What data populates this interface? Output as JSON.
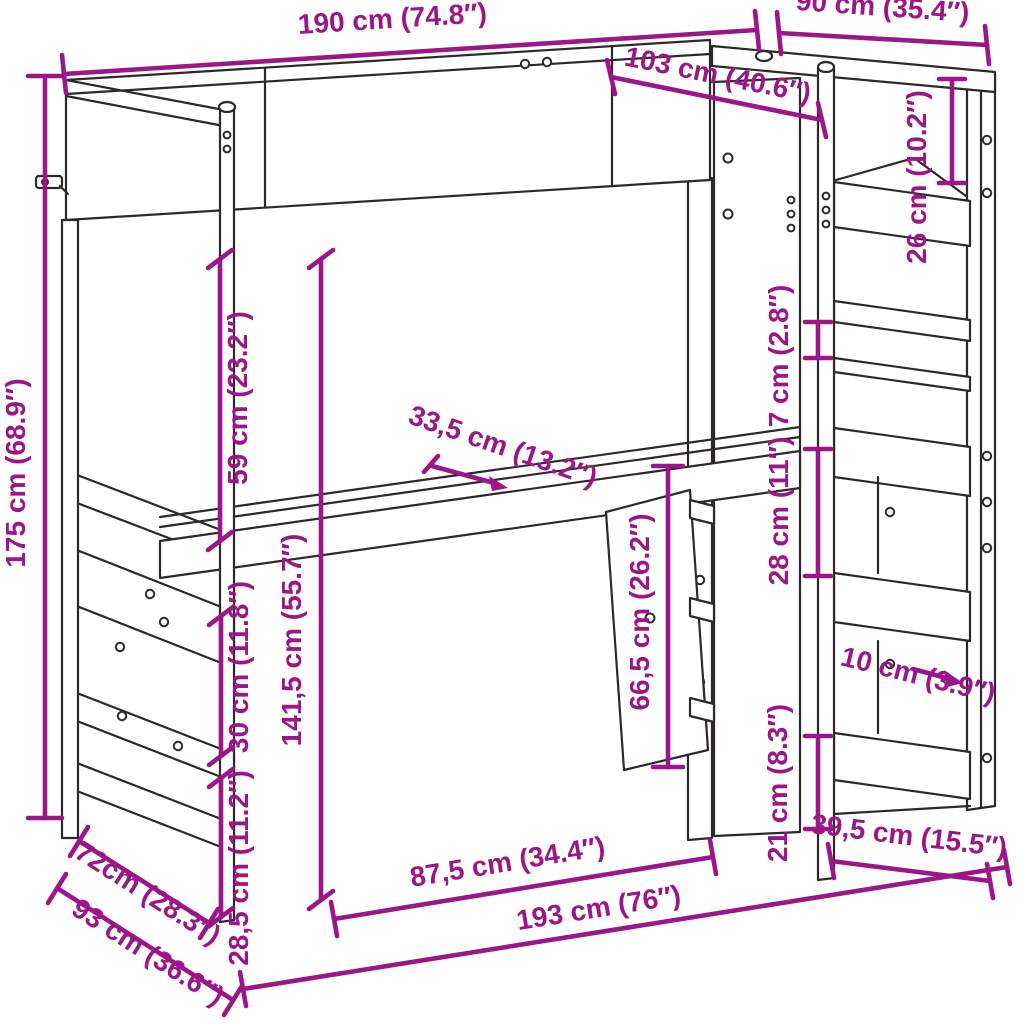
{
  "figure": {
    "kind": "furniture-dimension-diagram",
    "background_color": "#ffffff",
    "line_color": "#2d292a",
    "dimension_color": "#9b1687"
  },
  "dimensions": {
    "d190": {
      "label": "190 cm (74.8″)",
      "cm": "190",
      "inches": "74.8"
    },
    "d90": {
      "label": "90 cm (35.4″)",
      "cm": "90",
      "inches": "35.4"
    },
    "d103": {
      "label": "103 cm (40.6″)",
      "cm": "103",
      "inches": "40.6"
    },
    "d26": {
      "label": "26 cm (10.2″)",
      "cm": "26",
      "inches": "10.2"
    },
    "d7": {
      "label": "7 cm (2.8″)",
      "cm": "7",
      "inches": "2.8"
    },
    "d28": {
      "label": "28 cm (11″)",
      "cm": "28",
      "inches": "11"
    },
    "d10": {
      "label": "10 cm (3.9″)",
      "cm": "10",
      "inches": "3.9"
    },
    "d21": {
      "label": "21 cm (8.3″)",
      "cm": "21",
      "inches": "8.3"
    },
    "d395": {
      "label": "39,5 cm (15.5″)",
      "cm": "39,5",
      "inches": "15.5"
    },
    "d175": {
      "label": "175 cm (68.9″)",
      "cm": "175",
      "inches": "68.9"
    },
    "d59": {
      "label": "59 cm (23.2″)",
      "cm": "59",
      "inches": "23.2"
    },
    "d1415": {
      "label": "141,5 cm (55.7″)",
      "cm": "141,5",
      "inches": "55.7"
    },
    "d335": {
      "label": "33,5 cm (13.2″)",
      "cm": "33,5",
      "inches": "13.2"
    },
    "d665": {
      "label": "66,5 cm (26.2″)",
      "cm": "66,5",
      "inches": "26.2"
    },
    "d30": {
      "label": "30 cm (11.8″)",
      "cm": "30",
      "inches": "11.8"
    },
    "d285": {
      "label": "28,5 cm (11.2″)",
      "cm": "28,5",
      "inches": "11.2"
    },
    "d72": {
      "label": "72cm (28.3″)",
      "cm": "72",
      "inches": "28.3"
    },
    "d93": {
      "label": "93 cm (36.6″)",
      "cm": "93",
      "inches": "36.6"
    },
    "d875": {
      "label": "87,5 cm (34.4″)",
      "cm": "87,5",
      "inches": "34.4"
    },
    "d193": {
      "label": "193 cm (76″)",
      "cm": "193",
      "inches": "76"
    }
  }
}
